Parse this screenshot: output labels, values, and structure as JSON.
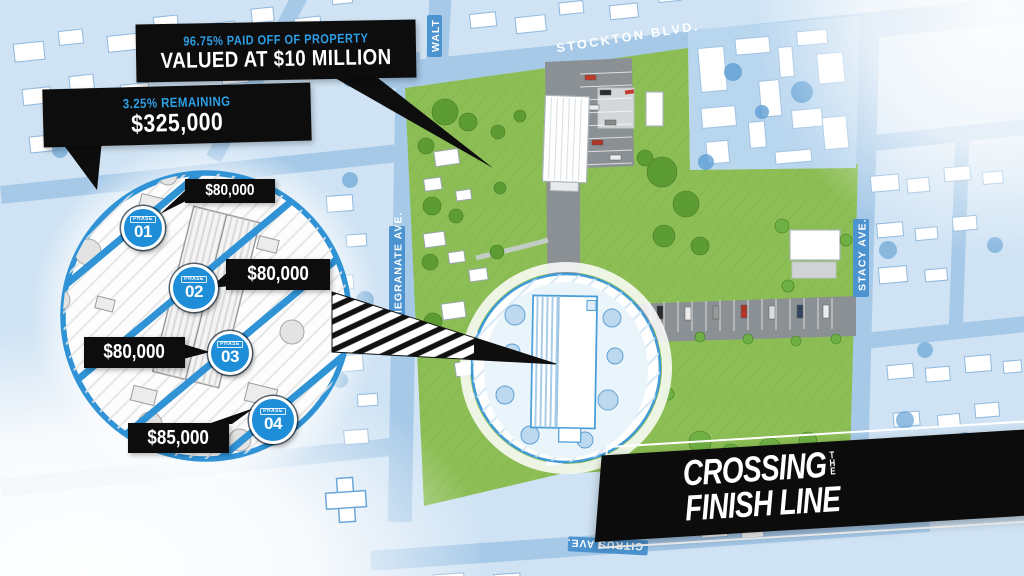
{
  "callouts": {
    "paid_off": {
      "line1": "96.75% PAID OFF OF PROPERTY",
      "line2": "VALUED AT $10 MILLION"
    },
    "remaining": {
      "line1": "3.25% REMAINING",
      "line2": "$325,000"
    }
  },
  "inset": {
    "phases": [
      {
        "badge_label": "PHASE",
        "number": "01",
        "amount": "$80,000"
      },
      {
        "badge_label": "PHASE",
        "number": "02",
        "amount": "$80,000"
      },
      {
        "badge_label": "PHASE",
        "number": "03",
        "amount": "$80,000"
      },
      {
        "badge_label": "PHASE",
        "number": "04",
        "amount": "$85,000"
      }
    ]
  },
  "streets": {
    "stockton": "STOCKTON BLVD.",
    "walt": "WALT",
    "stacy": "STACY AVE.",
    "pomegranate": "POMEGRANATE AVE.",
    "citrus": "CITRUS AVE."
  },
  "banner": {
    "line1": "CROSSING",
    "the": "THE",
    "line2": "FINISH LINE"
  },
  "colors": {
    "accent_blue": "#2e9fe6",
    "badge_blue": "#1e8ed8",
    "map_blue": "#cfe3f4",
    "street_blue": "#a6c9e8",
    "street_label_blue": "#4c93cf",
    "grass_green": "#8cbe55",
    "road_gray": "#8b9094",
    "callout_black": "#0d0d0d"
  }
}
